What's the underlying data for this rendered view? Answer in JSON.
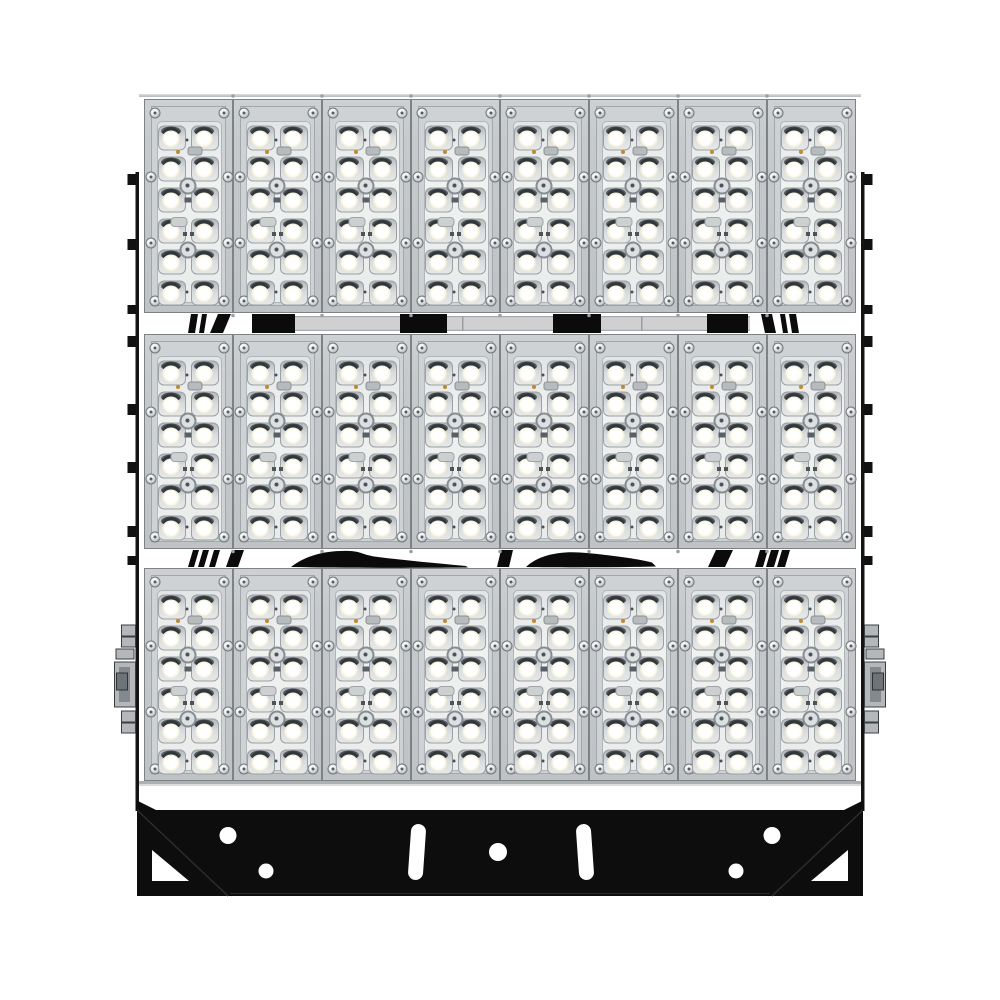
{
  "scene": {
    "type": "product-photo",
    "subject": "Modular high-power LED flood light, front view, white background",
    "visible_text": []
  },
  "fixture": {
    "module_rows": 3,
    "module_columns": 8,
    "module_count": 24,
    "led_rows_per_module": 6,
    "led_columns_per_module": 2,
    "leds_per_module": 12,
    "led_count_total": 288,
    "screws_per_module": 8
  },
  "mounting": {
    "bracket_description": "Black steel yoke plate with two curved vertical slots, five round holes and two triangular corner cutouts",
    "side_rail_description": "Vertical black side rails with gray clamp hinge hardware",
    "bracket_hole_count": 5,
    "bracket_slot_count": 2
  },
  "colors": {
    "background": "#ffffff",
    "module_frame": "#c6cacc",
    "module_frame_border": "#7d8285",
    "inner_panel": "#ced2d4",
    "lens_plate": "#eaeceb",
    "led_rim": "#9aa0a3",
    "led_bright": "#fffdf2",
    "led_shadow": "#30363a",
    "amber_dot": "#c08a30",
    "gap_strip": "#d0d0d0",
    "cable_black": "#0b0b0b",
    "rail_black": "#141414",
    "bracket_black": "#0d0d0d",
    "hardware_gray": "#b4b8ba"
  }
}
